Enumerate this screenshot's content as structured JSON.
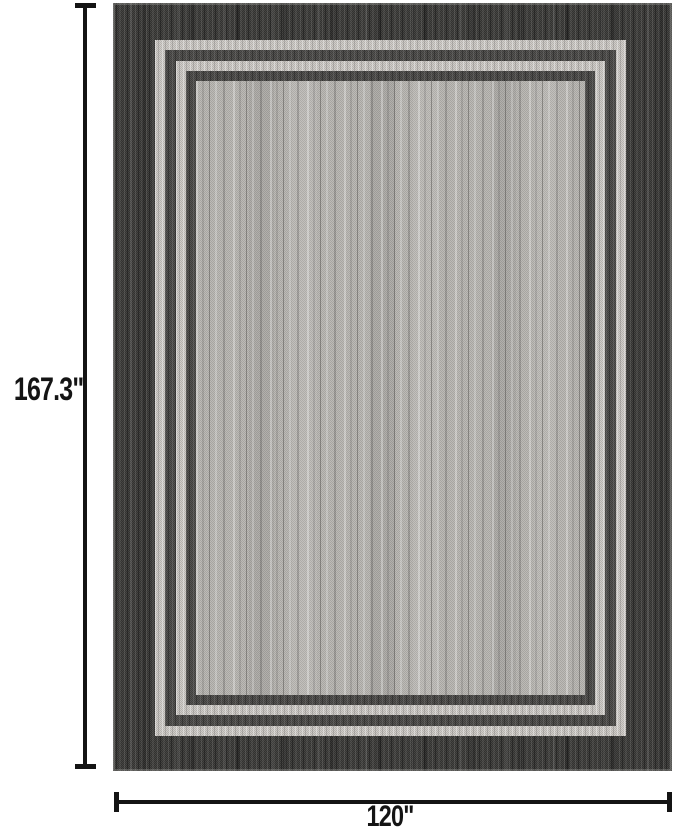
{
  "figure": {
    "type": "product-dimension-diagram",
    "background_color": "#ffffff",
    "height_dimension": {
      "label": "167.3\""
    },
    "width_dimension": {
      "label": "120\""
    }
  },
  "rug": {
    "description": "charcoal flatweave rug with double-line inner border frame and striated gray field",
    "colors": {
      "outer_border": "#3c3b39",
      "light_frame_line": "#c9c6c2",
      "dark_frame_line": "#4a4947",
      "field": "#b5b3af"
    }
  },
  "annotation": {
    "line_color": "#141414",
    "text_color": "#141414"
  }
}
